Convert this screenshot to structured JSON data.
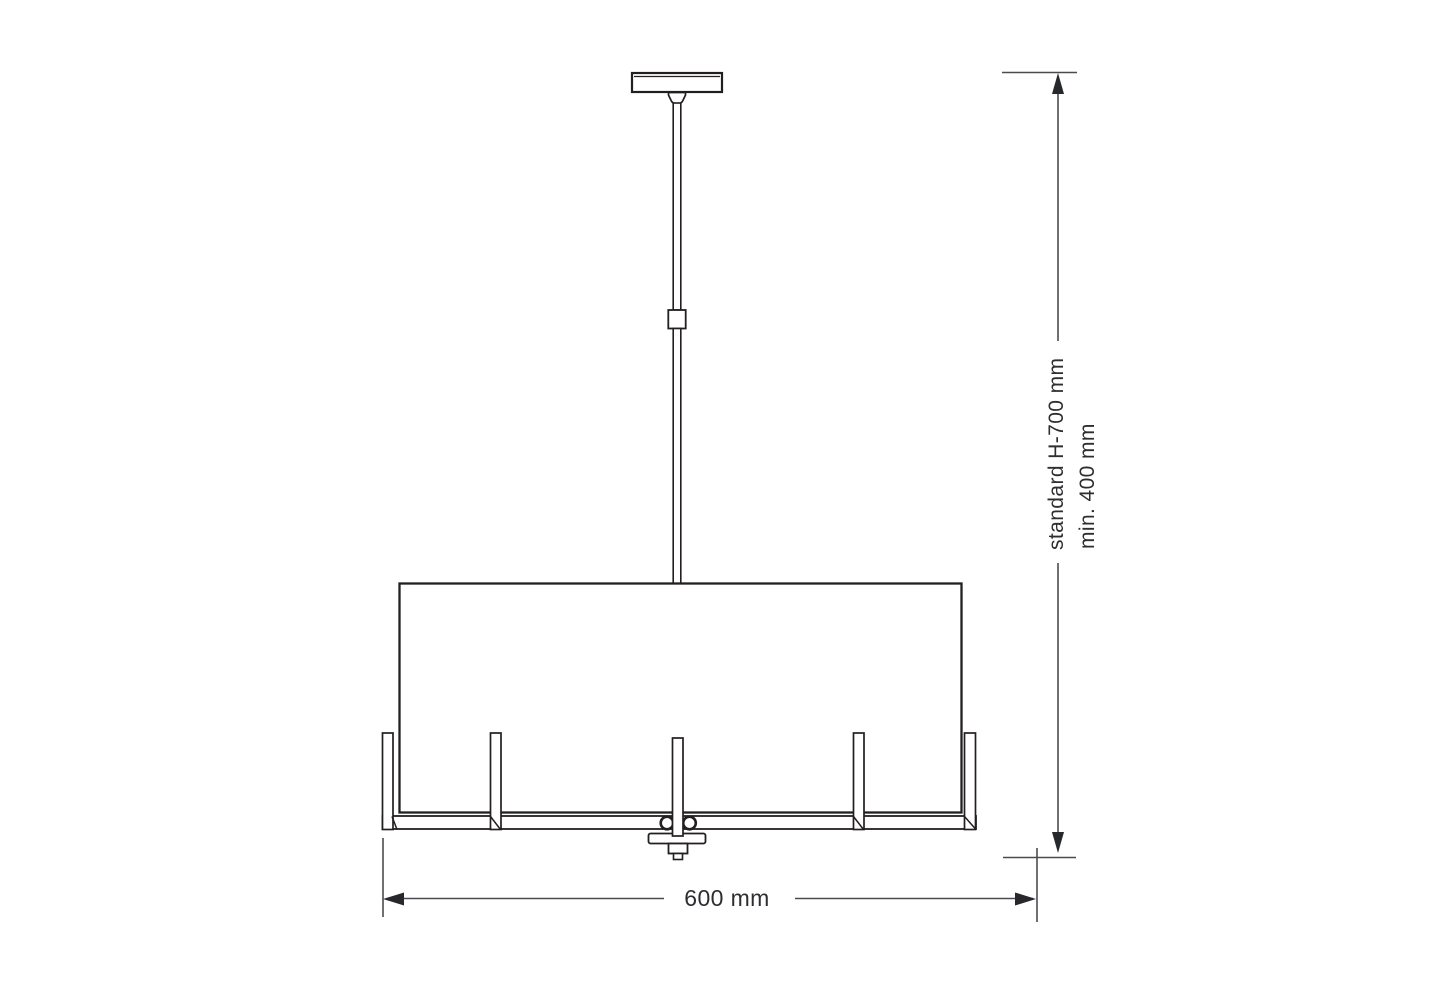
{
  "diagram": {
    "labels": {
      "width": "600 mm",
      "height_standard": "standard H-700 mm",
      "height_min": "min. 400 mm"
    },
    "colors": {
      "fixture_line": "#231f20",
      "dimension_line": "#4b4c50",
      "arrow": "#27282b",
      "label_text": "#2d2e31",
      "background": "#ffffff"
    }
  }
}
